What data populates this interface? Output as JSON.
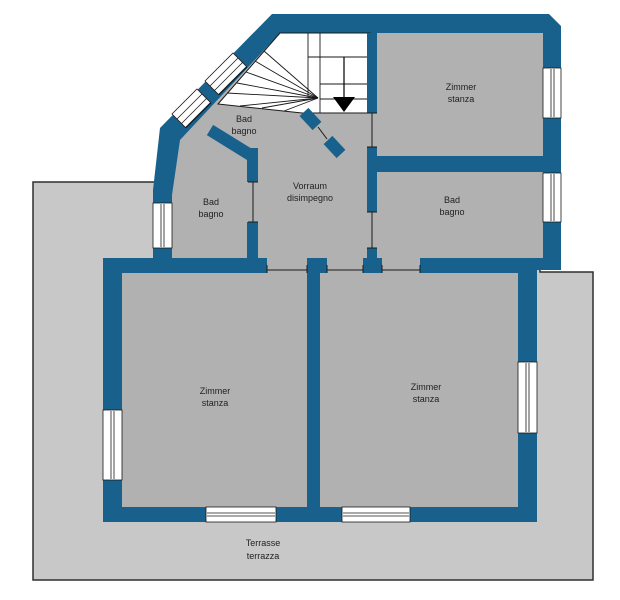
{
  "plan": {
    "type": "floor-plan",
    "colors": {
      "wall": "#17618c",
      "room_fill": "#b1b1b1",
      "terrace_fill": "#c8c8c8",
      "stair_fill": "#ffffff",
      "line": "#1a1a1a",
      "arrow": "#000000",
      "background": "#ffffff"
    },
    "rooms": [
      {
        "id": "bad-upper",
        "label_de": "Bad",
        "label_it": "bagno"
      },
      {
        "id": "bad-left",
        "label_de": "Bad",
        "label_it": "bagno"
      },
      {
        "id": "vorraum",
        "label_de": "Vorraum",
        "label_it": "disimpegno"
      },
      {
        "id": "zimmer-top",
        "label_de": "Zimmer",
        "label_it": "stanza"
      },
      {
        "id": "bad-right",
        "label_de": "Bad",
        "label_it": "bagno"
      },
      {
        "id": "zimmer-bottom-left",
        "label_de": "Zimmer",
        "label_it": "stanza"
      },
      {
        "id": "zimmer-bottom-right",
        "label_de": "Zimmer",
        "label_it": "stanza"
      },
      {
        "id": "terrace",
        "label_de": "Terrasse",
        "label_it": "terrazza"
      }
    ]
  }
}
